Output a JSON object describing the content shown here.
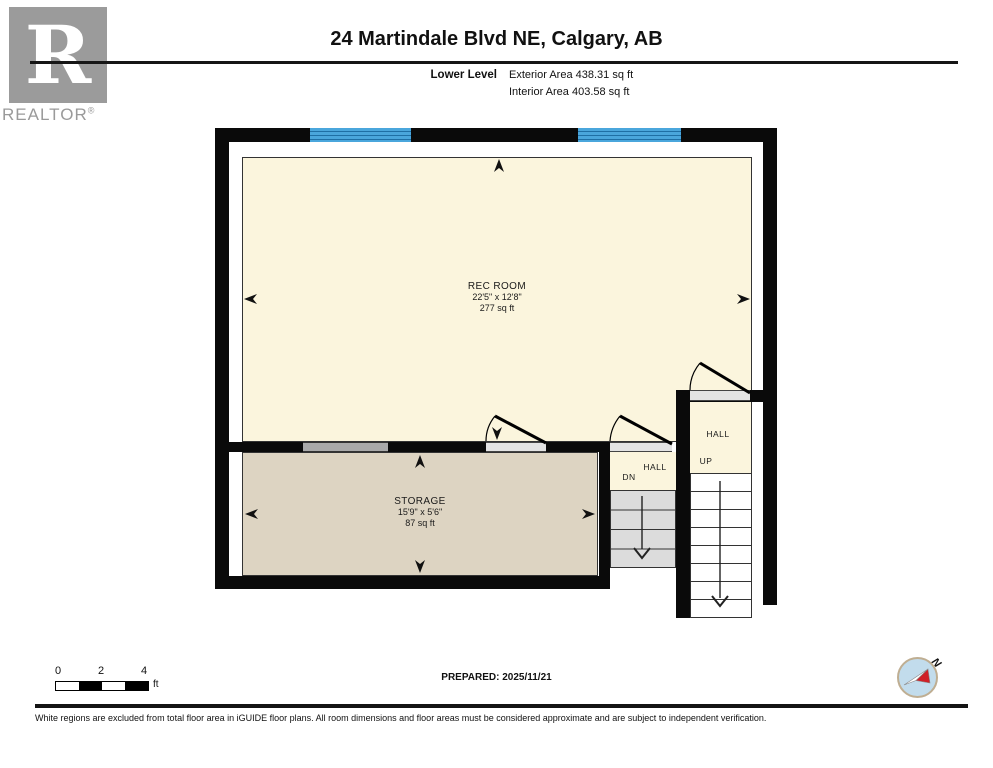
{
  "header": {
    "title": "24 Martindale Blvd NE, Calgary, AB",
    "level_label": "Lower Level",
    "exterior_area": "Exterior Area 438.31 sq ft",
    "interior_area": "Interior Area 403.58 sq ft"
  },
  "logo": {
    "letter": "R",
    "wordmark": "REALTOR",
    "registered": "®"
  },
  "rooms": {
    "rec_room": {
      "name": "REC ROOM",
      "dims": "22'5\" x 12'8\"",
      "area": "277 sq ft"
    },
    "storage": {
      "name": "STORAGE",
      "dims": "15'9\" x 5'6\"",
      "area": "87 sq ft"
    },
    "hall_dn": {
      "name": "HALL",
      "direction": "DN"
    },
    "hall_up": {
      "name": "HALL",
      "direction": "UP"
    }
  },
  "scale_bar": {
    "ticks": [
      "0",
      "2",
      "4"
    ],
    "unit": "ft"
  },
  "compass": {
    "north_label": "N"
  },
  "footer": {
    "prepared": "PREPARED: 2025/11/21",
    "disclaimer": "White regions are excluded from total floor area in iGUIDE floor plans. All room dimensions and floor areas must be considered approximate and are subject to independent verification."
  },
  "colors": {
    "wall": "#0a0a0a",
    "window_blue": "#4aa6dc",
    "room_cream": "#fbf5dd",
    "storage_tan": "#ddd4c2",
    "stair_gray": "#dcdcdc",
    "opening_gray": "#e3e3e3",
    "pony_gray": "#a9a9a9",
    "compass_red": "#cf2027",
    "compass_blue": "#c2dcec",
    "logo_gray": "#9b9b9b"
  }
}
